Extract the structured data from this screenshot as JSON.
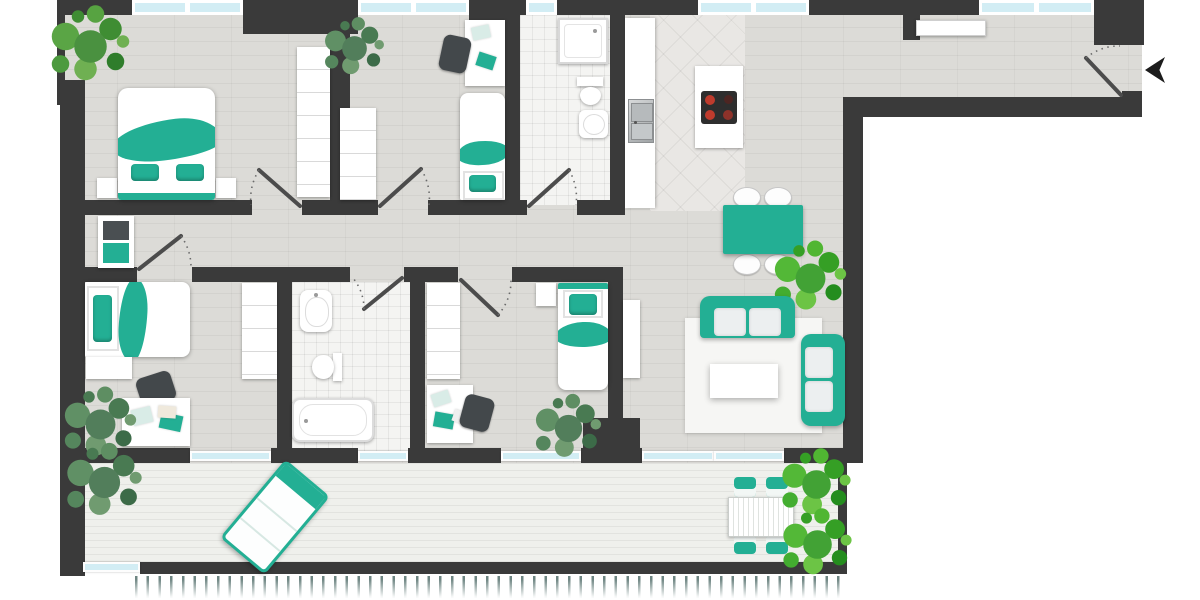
{
  "document": {
    "kind": "apartment-floor-plan",
    "text_labels": [],
    "colors": {
      "wall": "#3a3a3a",
      "accent": "#23af94",
      "accent_dark": "#17907a",
      "glass": "#d2edf4",
      "floor": "#dcdbd7",
      "tile": "#f4f4f2",
      "kitchen_tile": "#e9e7e4",
      "balcony_floor": "#eff0ec",
      "chair": "#43484b",
      "burner_red": "#bf3b2d",
      "plant_green": "#4a9140",
      "railing": "#6e8582"
    },
    "counts": {
      "windows_top": 5,
      "balcony_glass_panels": 6,
      "swing_doors": 7,
      "plants": 8
    },
    "rooms": [
      {
        "name": "bedroom-master",
        "position": "top-left",
        "furniture": [
          "double-bed-teal-blanket",
          "nightstand-left",
          "nightstand-right",
          "wardrobe",
          "potted-plant"
        ]
      },
      {
        "name": "bedroom-2",
        "position": "top-middle",
        "furniture": [
          "single-bed-teal-blanket",
          "desk-with-papers",
          "office-chair",
          "wardrobe",
          "potted-plant"
        ]
      },
      {
        "name": "bathroom-1",
        "position": "top",
        "furniture": [
          "shower",
          "toilet",
          "washbasin"
        ]
      },
      {
        "name": "kitchen",
        "position": "top-right-of-center",
        "furniture": [
          "counter-with-double-sink",
          "island-with-cooktop-4-burners",
          "dining-table-teal",
          "dining-chair x4"
        ]
      },
      {
        "name": "entrance-hallway",
        "position": "top-right",
        "furniture": [
          "sideboard",
          "entrance-door-with-swing",
          "entrance-arrow-marker"
        ]
      },
      {
        "name": "corridor",
        "position": "center-left",
        "furniture": [
          "dresser-two-drawers"
        ]
      },
      {
        "name": "bedroom-3",
        "position": "bottom-left",
        "furniture": [
          "single-bed-teal-blanket",
          "low-shelf",
          "desk-with-papers",
          "office-chair",
          "wardrobe",
          "potted-plant"
        ]
      },
      {
        "name": "bathroom-2",
        "position": "bottom-center-left",
        "furniture": [
          "washbasin",
          "toilet",
          "bathtub"
        ]
      },
      {
        "name": "bedroom-4",
        "position": "bottom-center",
        "furniture": [
          "single-bed-teal-blanket",
          "nightstand",
          "desk-with-papers",
          "office-chair",
          "wardrobe",
          "potted-plant"
        ]
      },
      {
        "name": "living-room",
        "position": "right",
        "furniture": [
          "sofa-three-seat-teal",
          "sofa-two-seat-teal",
          "white-rug",
          "coffee-table",
          "sideboard",
          "potted-plant"
        ]
      },
      {
        "name": "balcony",
        "position": "bottom full-width",
        "furniture": [
          "sun-lounger-diagonal",
          "outdoor-table-slatted",
          "outdoor-chair-teal x4",
          "potted-plant x3",
          "railing-hatching"
        ]
      }
    ]
  }
}
